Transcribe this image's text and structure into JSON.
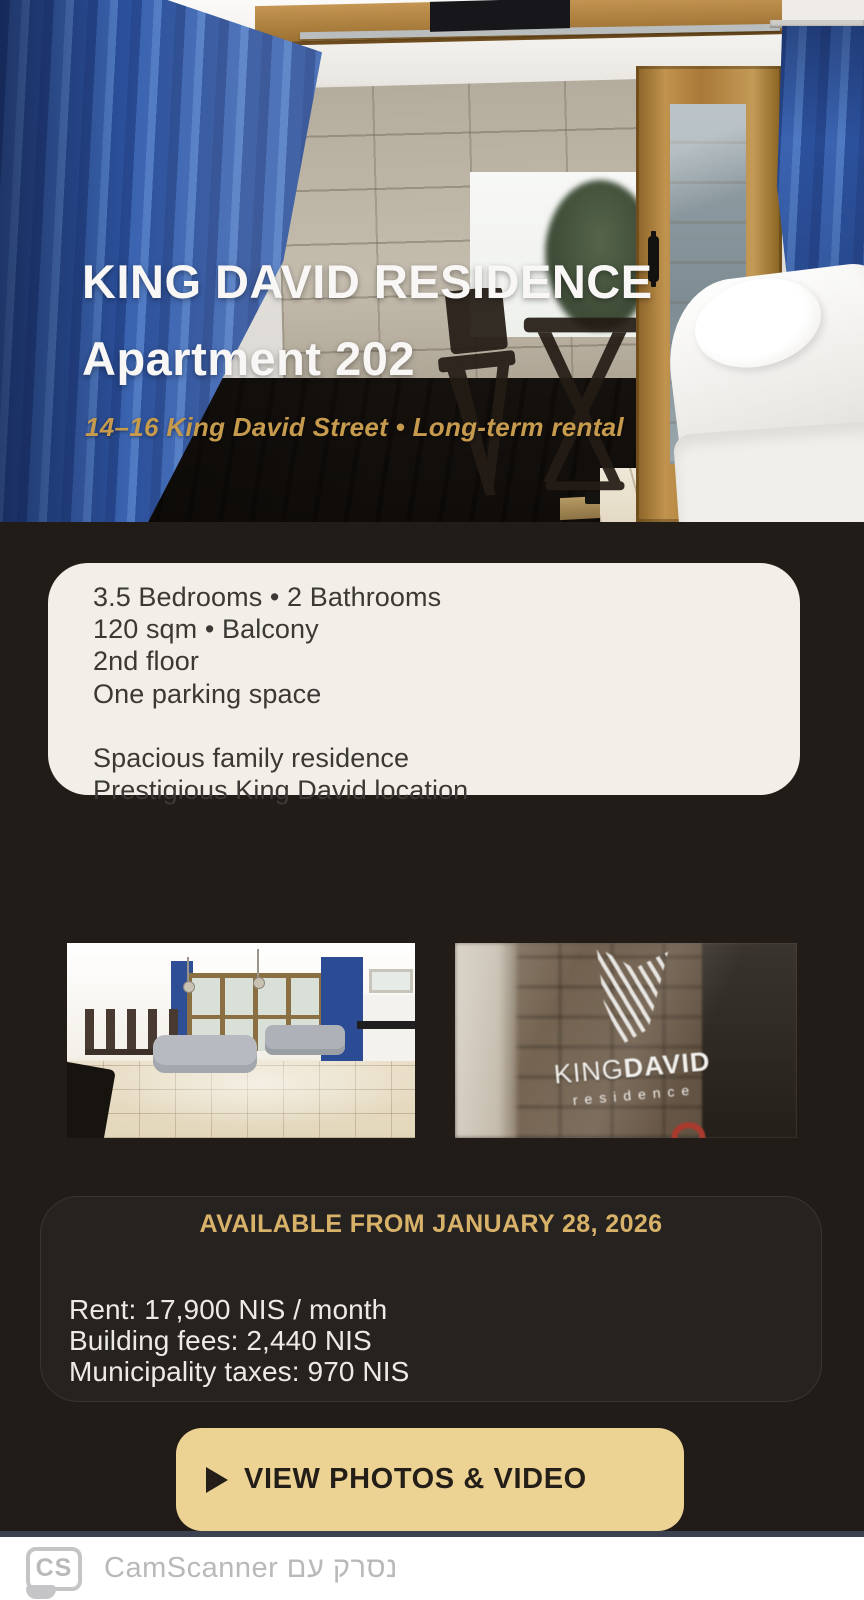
{
  "hero": {
    "title_line1": "KING DAVID RESIDENCE",
    "title_line2": "Apartment 202",
    "subtitle": "14–16 King David Street • Long-term rental"
  },
  "details_card": {
    "lines": [
      "3.5 Bedrooms • 2 Bathrooms",
      "120 sqm • Balcony",
      "2nd floor",
      "One parking space",
      "",
      "Spacious family residence",
      "Prestigious King David location"
    ]
  },
  "photos": {
    "brand": {
      "logo_top_thin": "KING",
      "logo_top_bold": "DAVID",
      "logo_sub": "residence"
    }
  },
  "availability": {
    "heading": "AVAILABLE FROM JANUARY 28, 2026",
    "lines": [
      "Rent: 17,900 NIS / month",
      "Building fees: 2,440 NIS",
      "Municipality taxes: 970 NIS"
    ]
  },
  "cta": {
    "label": "VIEW PHOTOS & VIDEO",
    "icon": "play-icon"
  },
  "watermark": {
    "logo_text": "CS",
    "text": "נסרק עם CamScanner"
  },
  "colors": {
    "background_dark": "#211c17",
    "card_cream": "#f1efe7",
    "accent_gold": "#d8b269",
    "subtitle_gold": "#c79b4e",
    "button_gold": "#ecd394",
    "curtain_blue": "#3a63b0",
    "watermark_gray": "#b9b9bb"
  }
}
